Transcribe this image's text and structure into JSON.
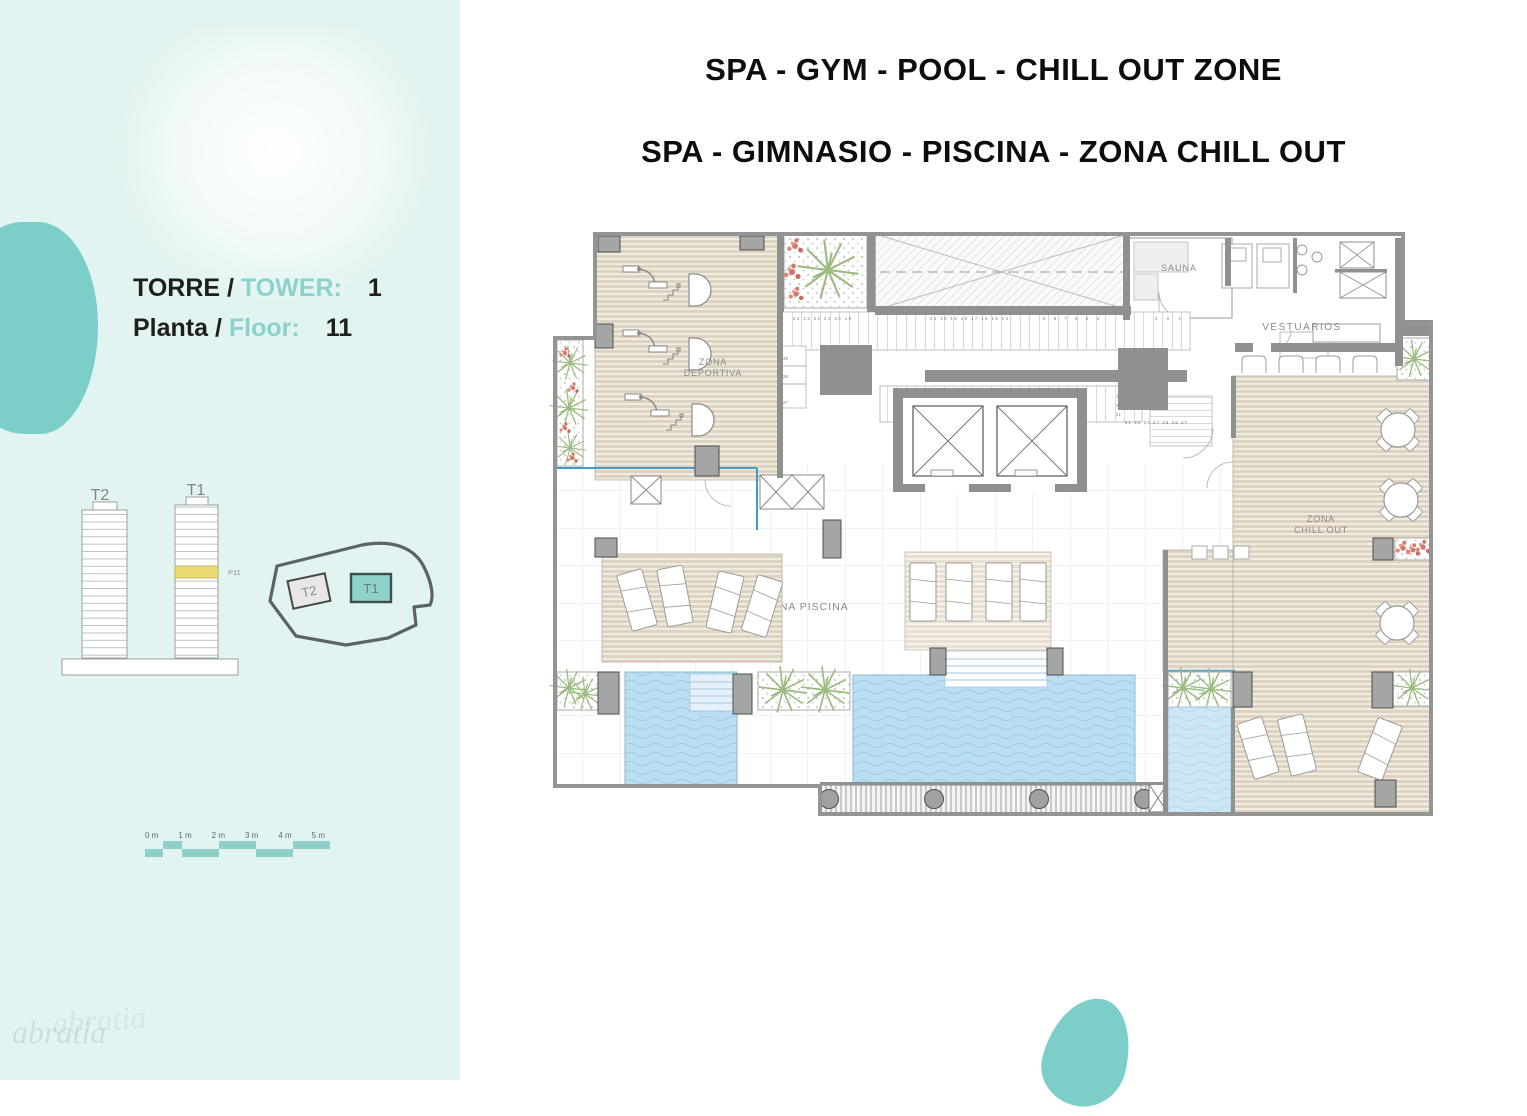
{
  "sidebar": {
    "tower_row": {
      "label_es": "TORRE /",
      "label_en": "TOWER:",
      "value": "1"
    },
    "floor_row": {
      "label_es": "Planta /",
      "label_en": "Floor:",
      "value": "11"
    },
    "towers": {
      "t2": "T2",
      "t1": "T1",
      "floor_tag": "P11"
    },
    "siteplan": {
      "t2": "T2",
      "t1": "T1"
    },
    "scale_labels": [
      "0 m",
      "1 m",
      "2 m",
      "3 m",
      "4 m",
      "5 m"
    ]
  },
  "titles": {
    "line1": "SPA - GYM - POOL - CHILL OUT ZONE",
    "line2": "SPA - GIMNASIO - PISCINA - ZONA CHILL OUT"
  },
  "plan": {
    "rooms": {
      "gym_line1": "ZONA",
      "gym_line2": "DEPORTIVA",
      "sauna": "SAUNA",
      "changing": "VESTUARIOS",
      "chill_line1": "ZONA",
      "chill_line2": "CHILL OUT",
      "pool": "ZONA PISCINA"
    },
    "stairs": {
      "top_run_a": "24 23 22 21 20 19",
      "top_run_b": "21 20 19 18 17 16 15 14",
      "top_run_c": "9 8 7 6 5 4",
      "top_run_d": "3 2 1",
      "left_col": [
        "25",
        "26",
        "27"
      ],
      "low_run_a": "4 5 6 7 8 9",
      "low_run_b": "13 14 15 16 17 18 19",
      "right_col": [
        "19",
        "20",
        "21"
      ],
      "bottom_row": "21 22 23 24 25 26 27"
    }
  },
  "legend": {
    "grava": "Grava",
    "jardinera": "Jardinera"
  },
  "watermark": "abratia",
  "colors": {
    "teal": "#7CCFC8",
    "accent_text": "#8AD2CB",
    "pool": "#BADEF2",
    "deck": "#DDD3C0",
    "wall": "#8F9191",
    "highlight_floor": "#EBDB74"
  }
}
